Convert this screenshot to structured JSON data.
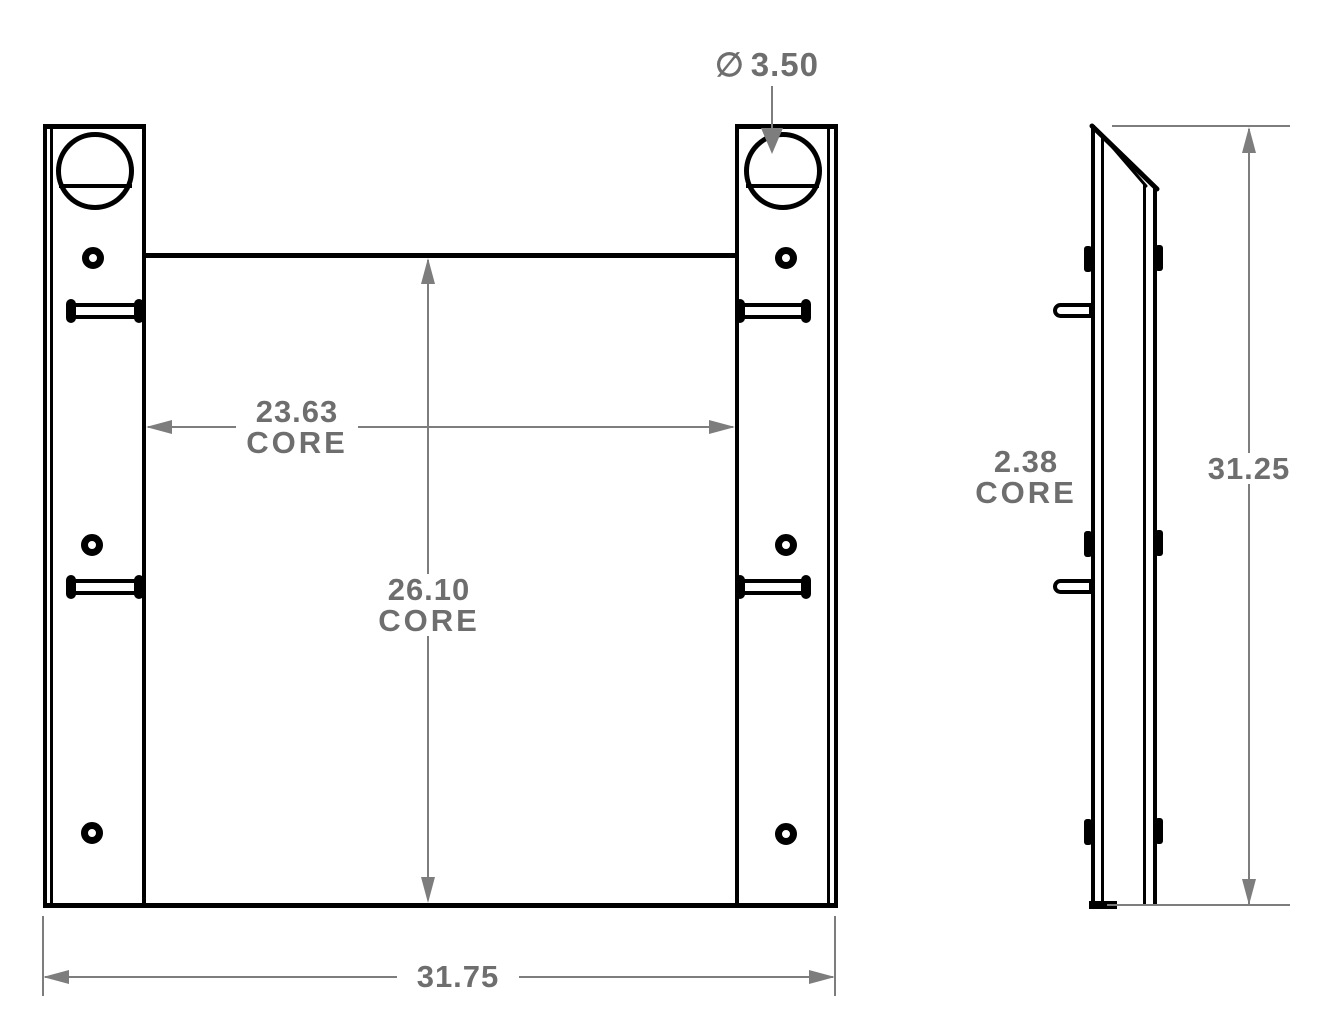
{
  "drawing": {
    "colors": {
      "background": "#ffffff",
      "part_line": "#000000",
      "dimension_line": "#7d7d7d",
      "dimension_text": "#6e6e6e"
    },
    "dimensions": {
      "hole_diameter": {
        "symbol": "∅",
        "value": "3.50"
      },
      "core_width": {
        "value": "23.63",
        "label": "CORE"
      },
      "core_height": {
        "value": "26.10",
        "label": "CORE"
      },
      "overall_width": {
        "value": "31.75"
      },
      "core_depth": {
        "value": "2.38",
        "label": "CORE"
      },
      "overall_height": {
        "value": "31.25"
      }
    }
  }
}
